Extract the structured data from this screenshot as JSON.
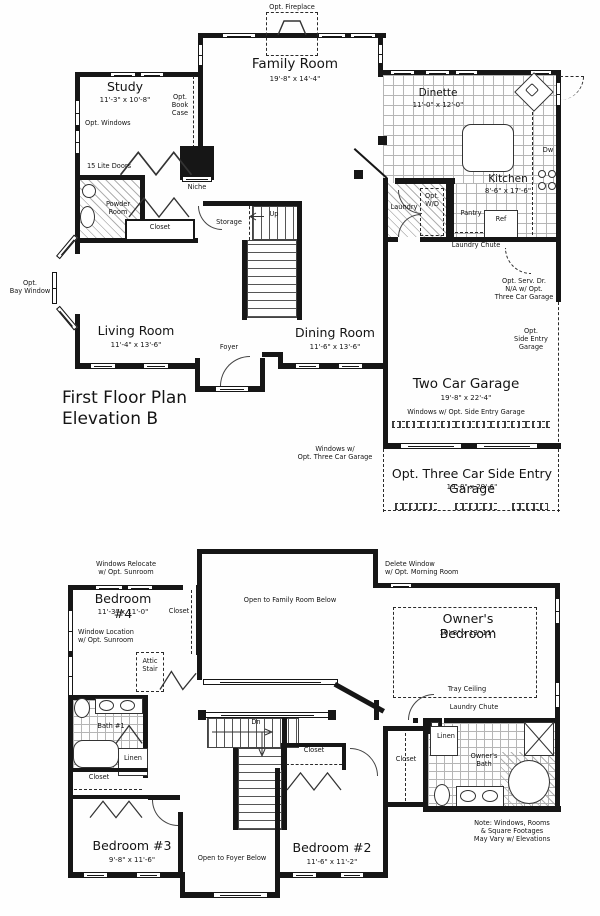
{
  "ff": {
    "title": "First Floor Plan\nElevation B",
    "family_name": "Family Room",
    "family_dims": "19'-8\" x 14'-4\"",
    "study_name": "Study",
    "study_dims": "11'-3\" x 10'-8\"",
    "dinette_name": "Dinette",
    "dinette_dims": "11'-0\" x 12'-0\"",
    "kitchen_name": "Kitchen",
    "kitchen_dims": "8'-6\" x 17'-6\"",
    "living_name": "Living Room",
    "living_dims": "11'-4\" x 13'-6\"",
    "dining_name": "Dining Room",
    "dining_dims": "11'-6\" x 13'-6\"",
    "garage2_name": "Two Car Garage",
    "garage2_dims": "19'-8\" x 22'-4\"",
    "garage3_name": "Opt. Three Car Side Entry Garage",
    "garage3_dims": "19'-8\" x 29'-6\"",
    "opt_fireplace": "Opt. Fireplace",
    "opt_windows": "Opt. Windows",
    "opt_book_case": "Opt.\nBook\nCase",
    "lite_doors": "15 Lite Doors",
    "powder": "Powder\nRoom",
    "closet": "Closet",
    "niche": "Niche",
    "storage": "Storage",
    "up": "Up",
    "foyer": "Foyer",
    "laundry": "Laundry",
    "opt_wd": "Opt.\nW/D",
    "pantry": "Pantry",
    "ref": "Ref",
    "dw": "Dw",
    "laundry_chute": "Laundry Chute",
    "opt_serv": "Opt. Serv. Dr.\nN/A w/ Opt.\nThree Car Garage",
    "opt_side_entry": "Opt.\nSide Entry\nGarage",
    "opt_bay": "Opt.\nBay Window",
    "win_side": "Windows w/ Opt. Side Entry Garage",
    "win_three": "Windows w/\nOpt. Three Car Garage"
  },
  "sf": {
    "bed4_name": "Bedroom #4",
    "bed4_dims": "11'-3\" x 11'-0\"",
    "owners_name": "Owner's Bedroom",
    "owners_dims": "19'-8\" x 13'-11\"",
    "bed3_name": "Bedroom #3",
    "bed3_dims": "9'-8\" x 11'-6\"",
    "bed2_name": "Bedroom #2",
    "bed2_dims": "11'-6\" x 11'-2\"",
    "win_relocate": "Windows Relocate\nw/ Opt. Sunroom",
    "win_location": "Window Location\nw/ Opt. Sunroom",
    "attic": "Attic\nStair",
    "closet": "Closet",
    "open_family": "Open to Family Room Below",
    "delete_win": "Delete Window\nw/ Opt. Morning Room",
    "tray": "Tray Ceiling",
    "chute": "Laundry Chute",
    "bath1": "Bath #1",
    "linen": "Linen",
    "dn": "Dn",
    "owners_bath": "Owner's\nBath",
    "open_foyer": "Open to Foyer Below",
    "note": "Note: Windows, Rooms\n& Square Footages\nMay Vary w/ Elevations"
  }
}
